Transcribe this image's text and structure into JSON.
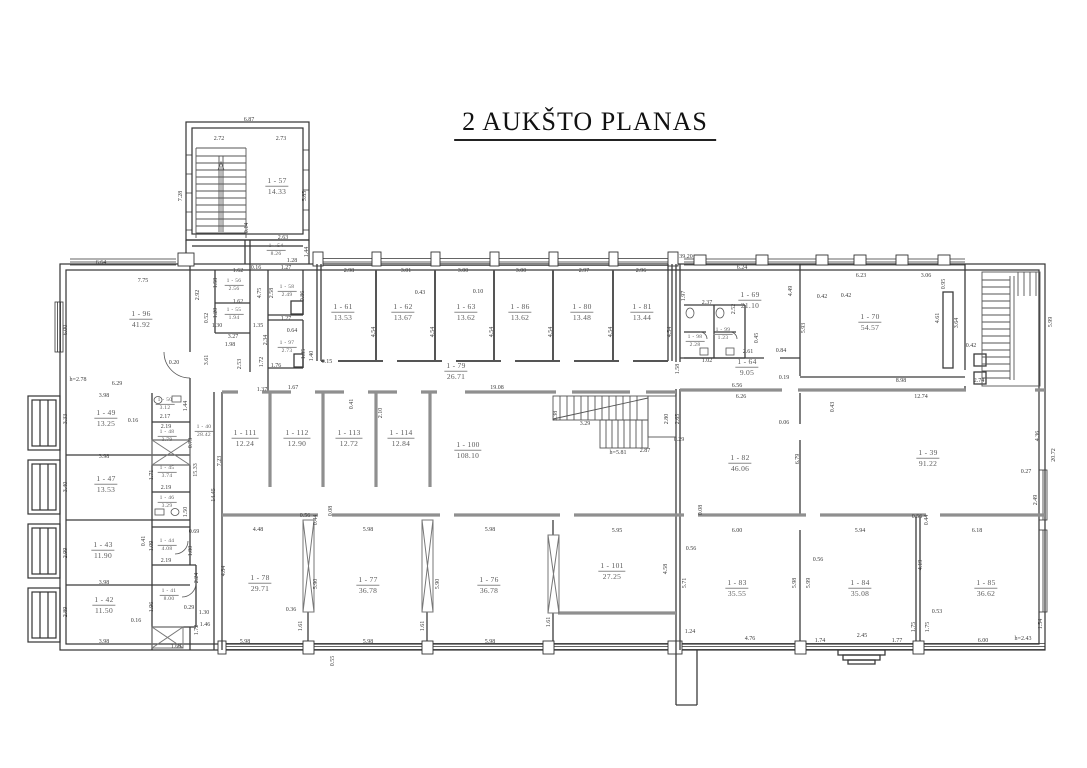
{
  "title": "2 AUKŠTO PLANAS",
  "drawing_colors": {
    "walls": "#3b3b3b",
    "thick_walls": "#8f8f8f",
    "text": "#5a5a5a",
    "background": "#ffffff"
  },
  "rooms": [
    {
      "number": "1 - 96",
      "area": "41.92",
      "x": 141,
      "y": 319
    },
    {
      "number": "1 - 57",
      "area": "14.33",
      "x": 277,
      "y": 186
    },
    {
      "number": "1 - 54",
      "area": "8.26",
      "x": 276,
      "y": 250,
      "s": true
    },
    {
      "number": "1 - 58",
      "area": "2.49",
      "x": 287,
      "y": 291,
      "s": true
    },
    {
      "number": "1 - 56",
      "area": "2.56",
      "x": 234,
      "y": 285,
      "s": true
    },
    {
      "number": "1 - 55",
      "area": "1.94",
      "x": 234,
      "y": 314,
      "s": true
    },
    {
      "number": "1 - 97",
      "area": "2.73",
      "x": 287,
      "y": 347,
      "s": true
    },
    {
      "number": "1 - 61",
      "area": "13.53",
      "x": 343,
      "y": 312
    },
    {
      "number": "1 - 62",
      "area": "13.67",
      "x": 403,
      "y": 312
    },
    {
      "number": "1 - 63",
      "area": "13.62",
      "x": 466,
      "y": 312
    },
    {
      "number": "1 - 86",
      "area": "13.62",
      "x": 520,
      "y": 312
    },
    {
      "number": "1 - 80",
      "area": "13.48",
      "x": 582,
      "y": 312
    },
    {
      "number": "1 - 81",
      "area": "13.44",
      "x": 642,
      "y": 312
    },
    {
      "number": "1 - 79",
      "area": "26.71",
      "x": 456,
      "y": 371
    },
    {
      "number": "1 - 69",
      "area": "21.10",
      "x": 750,
      "y": 300
    },
    {
      "number": "1 - 98",
      "area": "2.28",
      "x": 695,
      "y": 341,
      "s": true
    },
    {
      "number": "1 - 99",
      "area": "1.23",
      "x": 723,
      "y": 334,
      "s": true
    },
    {
      "number": "1 - 64",
      "area": "9.05",
      "x": 747,
      "y": 367
    },
    {
      "number": "1 - 70",
      "area": "54.57",
      "x": 870,
      "y": 322
    },
    {
      "number": "1 - 49",
      "area": "13.25",
      "x": 106,
      "y": 418
    },
    {
      "number": "1 - 50",
      "area": "3.12",
      "x": 165,
      "y": 404,
      "s": true
    },
    {
      "number": "1 - 48",
      "area": "3.79",
      "x": 167,
      "y": 436,
      "s": true
    },
    {
      "number": "1 - 40",
      "area": "28.42",
      "x": 204,
      "y": 431,
      "s": true
    },
    {
      "number": "1 - 47",
      "area": "13.53",
      "x": 106,
      "y": 484
    },
    {
      "number": "1 - 45",
      "area": "3.74",
      "x": 167,
      "y": 472,
      "s": true
    },
    {
      "number": "1 - 46",
      "area": "3.29",
      "x": 167,
      "y": 502,
      "s": true
    },
    {
      "number": "1 - 43",
      "area": "11.90",
      "x": 103,
      "y": 550
    },
    {
      "number": "1 - 44",
      "area": "4.08",
      "x": 167,
      "y": 545,
      "s": true
    },
    {
      "number": "1 - 42",
      "area": "11.50",
      "x": 104,
      "y": 605
    },
    {
      "number": "1 - 41",
      "area": "8.00",
      "x": 169,
      "y": 595,
      "s": true
    },
    {
      "number": "1 - 111",
      "area": "12.24",
      "x": 245,
      "y": 438
    },
    {
      "number": "1 - 112",
      "area": "12.90",
      "x": 297,
      "y": 438
    },
    {
      "number": "1 - 113",
      "area": "12.72",
      "x": 349,
      "y": 438
    },
    {
      "number": "1 - 114",
      "area": "12.84",
      "x": 401,
      "y": 438
    },
    {
      "number": "1 - 100",
      "area": "108.10",
      "x": 468,
      "y": 450
    },
    {
      "number": "1 - 82",
      "area": "46.06",
      "x": 740,
      "y": 463
    },
    {
      "number": "1 - 39",
      "area": "91.22",
      "x": 928,
      "y": 458
    },
    {
      "number": "1 - 78",
      "area": "29.71",
      "x": 260,
      "y": 583
    },
    {
      "number": "1 - 77",
      "area": "36.78",
      "x": 368,
      "y": 585
    },
    {
      "number": "1 - 76",
      "area": "36.78",
      "x": 489,
      "y": 585
    },
    {
      "number": "1 - 101",
      "area": "27.25",
      "x": 612,
      "y": 571
    },
    {
      "number": "1 - 83",
      "area": "35.55",
      "x": 737,
      "y": 588
    },
    {
      "number": "1 - 84",
      "area": "35.08",
      "x": 860,
      "y": 588
    },
    {
      "number": "1 - 85",
      "area": "36.62",
      "x": 986,
      "y": 588
    }
  ],
  "dimensions": [
    {
      "t": "6.87",
      "x": 249,
      "y": 120,
      "r": 0
    },
    {
      "t": "2.72",
      "x": 219,
      "y": 139,
      "r": 0
    },
    {
      "t": "2.73",
      "x": 281,
      "y": 139,
      "r": 0
    },
    {
      "t": "7.28",
      "x": 181,
      "y": 196,
      "r": 90
    },
    {
      "t": "5.85",
      "x": 305,
      "y": 196,
      "r": 90
    },
    {
      "t": "0.14",
      "x": 247,
      "y": 228,
      "r": 90
    },
    {
      "t": "2.63",
      "x": 283,
      "y": 238,
      "r": 0
    },
    {
      "t": "1.44",
      "x": 307,
      "y": 252,
      "r": 90
    },
    {
      "t": "1.28",
      "x": 292,
      "y": 261,
      "r": 0
    },
    {
      "t": "0.16",
      "x": 256,
      "y": 268,
      "r": 0
    },
    {
      "t": "4.75",
      "x": 260,
      "y": 293,
      "r": 90
    },
    {
      "t": "1.27",
      "x": 286,
      "y": 268,
      "r": 0
    },
    {
      "t": "2.58",
      "x": 272,
      "y": 293,
      "r": 90
    },
    {
      "t": "0.86",
      "x": 303,
      "y": 296,
      "r": 90
    },
    {
      "t": "1.27",
      "x": 286,
      "y": 319,
      "r": 0
    },
    {
      "t": "0.64",
      "x": 292,
      "y": 331,
      "r": 0
    },
    {
      "t": "2.34",
      "x": 266,
      "y": 340,
      "r": 90
    },
    {
      "t": "1.72",
      "x": 262,
      "y": 362,
      "r": 90
    },
    {
      "t": "1.35",
      "x": 258,
      "y": 326,
      "r": 0
    },
    {
      "t": "1.76",
      "x": 276,
      "y": 366,
      "r": 0
    },
    {
      "t": "1.40",
      "x": 312,
      "y": 356,
      "r": 90
    },
    {
      "t": "1.35",
      "x": 304,
      "y": 354,
      "r": 90
    },
    {
      "t": "0.15",
      "x": 327,
      "y": 362,
      "r": 0
    },
    {
      "t": "1.67",
      "x": 293,
      "y": 388,
      "r": 0
    },
    {
      "t": "1.37",
      "x": 262,
      "y": 390,
      "r": 0
    },
    {
      "t": "1.62",
      "x": 238,
      "y": 271,
      "r": 0
    },
    {
      "t": "1.58",
      "x": 216,
      "y": 283,
      "r": 90
    },
    {
      "t": "1.62",
      "x": 238,
      "y": 302,
      "r": 0
    },
    {
      "t": "1.20",
      "x": 216,
      "y": 313,
      "r": 90
    },
    {
      "t": "3.27",
      "x": 233,
      "y": 337,
      "r": 0
    },
    {
      "t": "1.98",
      "x": 230,
      "y": 345,
      "r": 0
    },
    {
      "t": "2.53",
      "x": 240,
      "y": 364,
      "r": 90
    },
    {
      "t": "0.52",
      "x": 207,
      "y": 318,
      "r": 90
    },
    {
      "t": "1.30",
      "x": 217,
      "y": 326,
      "r": 0
    },
    {
      "t": "3.61",
      "x": 207,
      "y": 360,
      "r": 90
    },
    {
      "t": "0.20",
      "x": 174,
      "y": 363,
      "r": 0
    },
    {
      "t": "h=2.78",
      "x": 78,
      "y": 380,
      "r": 0
    },
    {
      "t": "6.64",
      "x": 101,
      "y": 263,
      "r": 0
    },
    {
      "t": "7.75",
      "x": 143,
      "y": 281,
      "r": 0
    },
    {
      "t": "6.00",
      "x": 66,
      "y": 330,
      "r": 90
    },
    {
      "t": "6.29",
      "x": 117,
      "y": 384,
      "r": 0
    },
    {
      "t": "2.92",
      "x": 198,
      "y": 295,
      "r": 90
    },
    {
      "t": "2.98",
      "x": 349,
      "y": 271,
      "r": 0
    },
    {
      "t": "3.01",
      "x": 406,
      "y": 271,
      "r": 0
    },
    {
      "t": "3.00",
      "x": 463,
      "y": 271,
      "r": 0
    },
    {
      "t": "3.00",
      "x": 521,
      "y": 271,
      "r": 0
    },
    {
      "t": "2.97",
      "x": 584,
      "y": 271,
      "r": 0
    },
    {
      "t": "2.96",
      "x": 641,
      "y": 271,
      "r": 0
    },
    {
      "t": "0.43",
      "x": 420,
      "y": 293,
      "r": 0
    },
    {
      "t": "0.10",
      "x": 478,
      "y": 292,
      "r": 0
    },
    {
      "t": "4.54",
      "x": 374,
      "y": 332,
      "r": 90
    },
    {
      "t": "4.54",
      "x": 433,
      "y": 332,
      "r": 90
    },
    {
      "t": "4.54",
      "x": 492,
      "y": 332,
      "r": 90
    },
    {
      "t": "4.54",
      "x": 551,
      "y": 332,
      "r": 90
    },
    {
      "t": "4.54",
      "x": 611,
      "y": 332,
      "r": 90
    },
    {
      "t": "4.54",
      "x": 670,
      "y": 332,
      "r": 90
    },
    {
      "t": "19.08",
      "x": 497,
      "y": 388,
      "r": 0
    },
    {
      "t": "39.20",
      "x": 686,
      "y": 257,
      "r": 0
    },
    {
      "t": "6.24",
      "x": 742,
      "y": 268,
      "r": 0
    },
    {
      "t": "1.97",
      "x": 684,
      "y": 296,
      "r": 90
    },
    {
      "t": "2.37",
      "x": 707,
      "y": 303,
      "r": 0
    },
    {
      "t": "4.49",
      "x": 791,
      "y": 291,
      "r": 90
    },
    {
      "t": "0.42",
      "x": 822,
      "y": 297,
      "r": 0
    },
    {
      "t": "5.93",
      "x": 804,
      "y": 328,
      "r": 90
    },
    {
      "t": "2.52",
      "x": 734,
      "y": 309,
      "r": 90
    },
    {
      "t": "0.45",
      "x": 757,
      "y": 338,
      "r": 90
    },
    {
      "t": "2.61",
      "x": 748,
      "y": 352,
      "r": 0
    },
    {
      "t": "0.84",
      "x": 781,
      "y": 351,
      "r": 0
    },
    {
      "t": "1.58",
      "x": 678,
      "y": 369,
      "r": 90
    },
    {
      "t": "6.56",
      "x": 737,
      "y": 386,
      "r": 0
    },
    {
      "t": "0.19",
      "x": 784,
      "y": 378,
      "r": 0
    },
    {
      "t": "1.02",
      "x": 707,
      "y": 361,
      "r": 0
    },
    {
      "t": "6.23",
      "x": 861,
      "y": 276,
      "r": 0
    },
    {
      "t": "3.06",
      "x": 926,
      "y": 276,
      "r": 0
    },
    {
      "t": "0.95",
      "x": 944,
      "y": 284,
      "r": 90
    },
    {
      "t": "0.42",
      "x": 846,
      "y": 296,
      "r": 0
    },
    {
      "t": "4.61",
      "x": 938,
      "y": 318,
      "r": 90
    },
    {
      "t": "3.64",
      "x": 957,
      "y": 323,
      "r": 90
    },
    {
      "t": "0.42",
      "x": 971,
      "y": 346,
      "r": 0
    },
    {
      "t": "8.98",
      "x": 901,
      "y": 381,
      "r": 0
    },
    {
      "t": "2.74",
      "x": 979,
      "y": 381,
      "r": 0
    },
    {
      "t": "5.99",
      "x": 1051,
      "y": 322,
      "r": 90
    },
    {
      "t": "3.98",
      "x": 104,
      "y": 396,
      "r": 0
    },
    {
      "t": "3.33",
      "x": 66,
      "y": 419,
      "r": 90
    },
    {
      "t": "0.16",
      "x": 133,
      "y": 421,
      "r": 0
    },
    {
      "t": "2.17",
      "x": 165,
      "y": 417,
      "r": 0
    },
    {
      "t": "1.44",
      "x": 186,
      "y": 406,
      "r": 90
    },
    {
      "t": "2.19",
      "x": 166,
      "y": 427,
      "r": 0
    },
    {
      "t": "0.73",
      "x": 191,
      "y": 443,
      "r": 90
    },
    {
      "t": "3.98",
      "x": 104,
      "y": 457,
      "r": 0
    },
    {
      "t": "3.40",
      "x": 66,
      "y": 487,
      "r": 90
    },
    {
      "t": "1.71",
      "x": 152,
      "y": 475,
      "r": 90
    },
    {
      "t": "2.19",
      "x": 166,
      "y": 488,
      "r": 0
    },
    {
      "t": "1.50",
      "x": 186,
      "y": 512,
      "r": 90
    },
    {
      "t": "15.33",
      "x": 196,
      "y": 470,
      "r": 90
    },
    {
      "t": "7.23",
      "x": 220,
      "y": 461,
      "r": 90
    },
    {
      "t": "14.45",
      "x": 214,
      "y": 495,
      "r": 90
    },
    {
      "t": "0.69",
      "x": 194,
      "y": 532,
      "r": 0
    },
    {
      "t": "1.09",
      "x": 152,
      "y": 546,
      "r": 90
    },
    {
      "t": "1.80",
      "x": 191,
      "y": 551,
      "r": 90
    },
    {
      "t": "2.19",
      "x": 166,
      "y": 561,
      "r": 0
    },
    {
      "t": "0.41",
      "x": 144,
      "y": 541,
      "r": 90
    },
    {
      "t": "2.99",
      "x": 66,
      "y": 553,
      "r": 90
    },
    {
      "t": "3.98",
      "x": 104,
      "y": 583,
      "r": 0
    },
    {
      "t": "2.89",
      "x": 66,
      "y": 612,
      "r": 90
    },
    {
      "t": "3.98",
      "x": 104,
      "y": 642,
      "r": 0
    },
    {
      "t": "2.24",
      "x": 197,
      "y": 578,
      "r": 90
    },
    {
      "t": "0.29",
      "x": 189,
      "y": 608,
      "r": 0
    },
    {
      "t": "1.96",
      "x": 152,
      "y": 607,
      "r": 90
    },
    {
      "t": "0.16",
      "x": 136,
      "y": 621,
      "r": 0
    },
    {
      "t": "1.72",
      "x": 197,
      "y": 630,
      "r": 90
    },
    {
      "t": "1.60",
      "x": 176,
      "y": 647,
      "r": 0
    },
    {
      "t": "1.46",
      "x": 205,
      "y": 625,
      "r": 0
    },
    {
      "t": "1.30",
      "x": 204,
      "y": 613,
      "r": 0
    },
    {
      "t": "0.41",
      "x": 352,
      "y": 404,
      "r": 90
    },
    {
      "t": "2.10",
      "x": 381,
      "y": 413,
      "r": 90
    },
    {
      "t": "3.29",
      "x": 585,
      "y": 424,
      "r": 0
    },
    {
      "t": "1.38",
      "x": 556,
      "y": 416,
      "r": 90
    },
    {
      "t": "2.87",
      "x": 645,
      "y": 451,
      "r": 0
    },
    {
      "t": "h=5.81",
      "x": 618,
      "y": 453,
      "r": 0
    },
    {
      "t": "2.80",
      "x": 667,
      "y": 419,
      "r": 90
    },
    {
      "t": "2.65",
      "x": 678,
      "y": 419,
      "r": 90
    },
    {
      "t": "0.29",
      "x": 679,
      "y": 440,
      "r": 0
    },
    {
      "t": "6.26",
      "x": 741,
      "y": 397,
      "r": 0
    },
    {
      "t": "0.06",
      "x": 784,
      "y": 423,
      "r": 0
    },
    {
      "t": "6.79",
      "x": 798,
      "y": 459,
      "r": 90
    },
    {
      "t": "0.43",
      "x": 833,
      "y": 407,
      "r": 90
    },
    {
      "t": "12.74",
      "x": 921,
      "y": 397,
      "r": 0
    },
    {
      "t": "4.36",
      "x": 1038,
      "y": 436,
      "r": 90
    },
    {
      "t": "0.27",
      "x": 1026,
      "y": 472,
      "r": 0
    },
    {
      "t": "2.49",
      "x": 1036,
      "y": 500,
      "r": 90
    },
    {
      "t": "20.72",
      "x": 1054,
      "y": 455,
      "r": 90
    },
    {
      "t": "0.08",
      "x": 701,
      "y": 510,
      "r": 90
    },
    {
      "t": "0.56",
      "x": 305,
      "y": 516,
      "r": 0
    },
    {
      "t": "0.44",
      "x": 316,
      "y": 520,
      "r": 90
    },
    {
      "t": "0.08",
      "x": 331,
      "y": 511,
      "r": 90
    },
    {
      "t": "4.48",
      "x": 258,
      "y": 530,
      "r": 0
    },
    {
      "t": "5.98",
      "x": 368,
      "y": 530,
      "r": 0
    },
    {
      "t": "5.98",
      "x": 490,
      "y": 530,
      "r": 0
    },
    {
      "t": "5.95",
      "x": 617,
      "y": 531,
      "r": 0
    },
    {
      "t": "6.00",
      "x": 737,
      "y": 531,
      "r": 0
    },
    {
      "t": "5.94",
      "x": 860,
      "y": 531,
      "r": 0
    },
    {
      "t": "6.18",
      "x": 977,
      "y": 531,
      "r": 0
    },
    {
      "t": "0.56",
      "x": 691,
      "y": 549,
      "r": 0
    },
    {
      "t": "0.56",
      "x": 818,
      "y": 560,
      "r": 0
    },
    {
      "t": "0.56",
      "x": 917,
      "y": 517,
      "r": 0
    },
    {
      "t": "0.44",
      "x": 927,
      "y": 520,
      "r": 90
    },
    {
      "t": "4.84",
      "x": 224,
      "y": 571,
      "r": 90
    },
    {
      "t": "5.90",
      "x": 316,
      "y": 584,
      "r": 90
    },
    {
      "t": "5.90",
      "x": 438,
      "y": 584,
      "r": 90
    },
    {
      "t": "4.58",
      "x": 666,
      "y": 569,
      "r": 90
    },
    {
      "t": "5.71",
      "x": 685,
      "y": 583,
      "r": 90
    },
    {
      "t": "5.98",
      "x": 795,
      "y": 583,
      "r": 90
    },
    {
      "t": "5.99",
      "x": 809,
      "y": 583,
      "r": 90
    },
    {
      "t": "4.19",
      "x": 921,
      "y": 565,
      "r": 90
    },
    {
      "t": "0.36",
      "x": 291,
      "y": 610,
      "r": 0
    },
    {
      "t": "1.61",
      "x": 301,
      "y": 626,
      "r": 90
    },
    {
      "t": "1.61",
      "x": 423,
      "y": 626,
      "r": 90
    },
    {
      "t": "1.61",
      "x": 549,
      "y": 622,
      "r": 90
    },
    {
      "t": "1.24",
      "x": 690,
      "y": 632,
      "r": 0
    },
    {
      "t": "4.76",
      "x": 750,
      "y": 639,
      "r": 0
    },
    {
      "t": "0.53",
      "x": 937,
      "y": 612,
      "r": 0
    },
    {
      "t": "1.75",
      "x": 914,
      "y": 627,
      "r": 90
    },
    {
      "t": "1.75",
      "x": 928,
      "y": 627,
      "r": 90
    },
    {
      "t": "1.77",
      "x": 897,
      "y": 641,
      "r": 0
    },
    {
      "t": "2.45",
      "x": 862,
      "y": 636,
      "r": 0
    },
    {
      "t": "1.74",
      "x": 820,
      "y": 641,
      "r": 0
    },
    {
      "t": "6.00",
      "x": 983,
      "y": 641,
      "r": 0
    },
    {
      "t": "h=2.43",
      "x": 1023,
      "y": 639,
      "r": 0
    },
    {
      "t": "1.54",
      "x": 1041,
      "y": 624,
      "r": 90
    },
    {
      "t": "5.98",
      "x": 245,
      "y": 642,
      "r": 0
    },
    {
      "t": "5.98",
      "x": 368,
      "y": 642,
      "r": 0
    },
    {
      "t": "5.98",
      "x": 490,
      "y": 642,
      "r": 0
    },
    {
      "t": "0.55",
      "x": 333,
      "y": 661,
      "r": 90
    }
  ]
}
